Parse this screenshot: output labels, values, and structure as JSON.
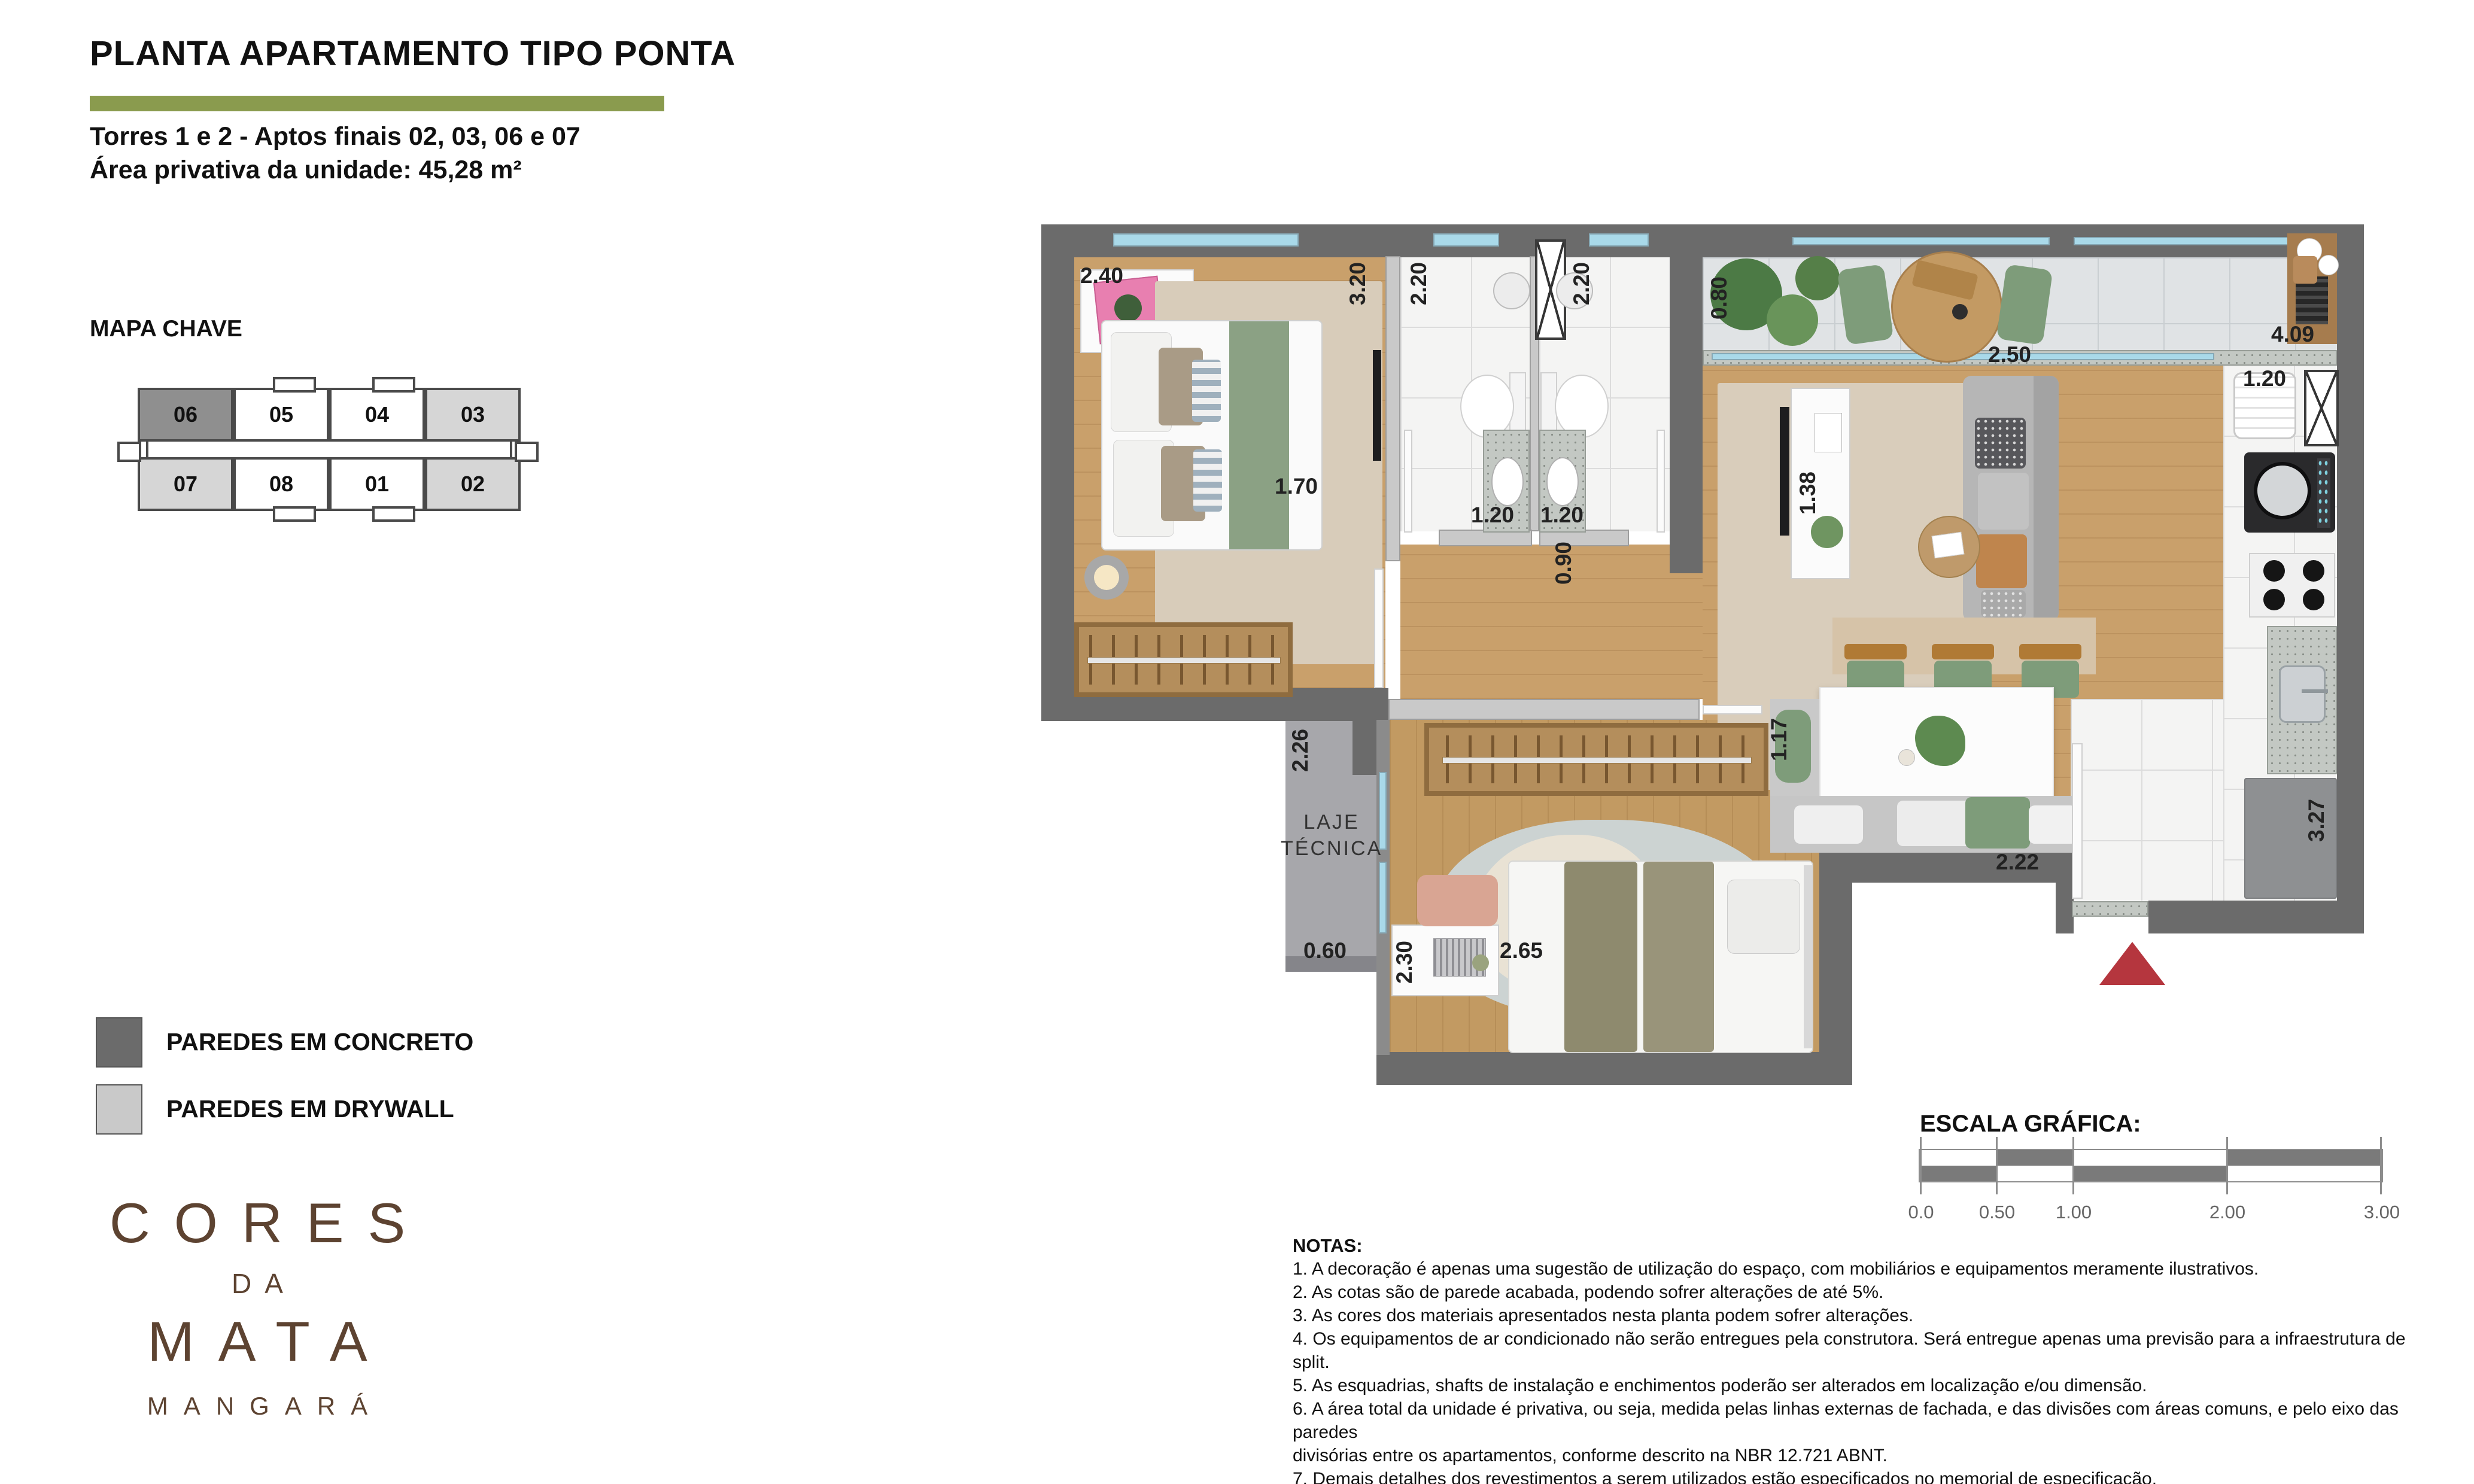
{
  "header": {
    "title": "PLANTA APARTAMENTO TIPO PONTA",
    "subtitle_line1": "Torres 1 e 2 - Aptos finais 02, 03, 06 e 07",
    "subtitle_line2": "Área privativa da unidade: 45,28 m²"
  },
  "key_map": {
    "title": "MAPA CHAVE",
    "top_row": [
      "06",
      "05",
      "04",
      "03"
    ],
    "bottom_row": [
      "07",
      "08",
      "01",
      "02"
    ],
    "highlight_unit": "06",
    "shaded_units": [
      "03",
      "07",
      "02"
    ]
  },
  "legend": {
    "concrete_label": "PAREDES EM CONCRETO",
    "drywall_label": "PAREDES EM DRYWALL",
    "concrete_color": "#6b6b6b",
    "drywall_color": "#c9c9c9"
  },
  "logo": {
    "line1": "CORES",
    "line2": "DA",
    "line3": "MATA",
    "line4": "MANGARÁ"
  },
  "plan": {
    "laje_line1": "LAJE",
    "laje_line2": "TÉCNICA",
    "dims": {
      "d1": "2.40",
      "d2": "3.20",
      "d3": "2.20",
      "d4": "2.20",
      "d5": "0.80",
      "d6": "4.09",
      "d7": "2.50",
      "d8": "1.20",
      "d9": "1.38",
      "d10": "1.20",
      "d11": "1.20",
      "d12": "0.90",
      "d13": "1.70",
      "d14": "2.26",
      "d15": "1.17",
      "d16": "2.22",
      "d17": "3.27",
      "d18": "0.60",
      "d19": "2.30",
      "d20": "2.65"
    }
  },
  "scale_bar": {
    "title": "ESCALA GRÁFICA:",
    "ticks": [
      "0.0",
      "0.50",
      "1.00",
      "2.00",
      "3.00"
    ]
  },
  "notes": {
    "title": "NOTAS:",
    "lines": [
      "1. A decoração é apenas uma sugestão de utilização do espaço, com mobiliários e equipamentos meramente ilustrativos.",
      "2. As cotas são de parede acabada, podendo sofrer alterações de até 5%.",
      "3. As cores dos materiais apresentados nesta planta podem sofrer alterações.",
      "4. Os equipamentos de ar condicionado não serão entregues pela construtora. Será entregue apenas uma previsão para a infraestrutura de split.",
      "5. As esquadrias, shafts de instalação e enchimentos poderão ser alterados em localização e/ou dimensão.",
      "6. A área total da unidade é privativa, ou seja, medida pelas linhas externas de fachada, e das divisões com áreas comuns, e pelo eixo das paredes",
      "divisórias entre os apartamentos, conforme descrito na NBR 12.721 ABNT.",
      "7. Demais detalhes dos revestimentos a serem utilizados estão especificados no memorial de especificação."
    ]
  },
  "colors": {
    "accent_green": "#8a9b4e",
    "logo_brown": "#5d4331",
    "entry_marker_red": "#b5363e",
    "window_blue": "#a9d9e9"
  }
}
